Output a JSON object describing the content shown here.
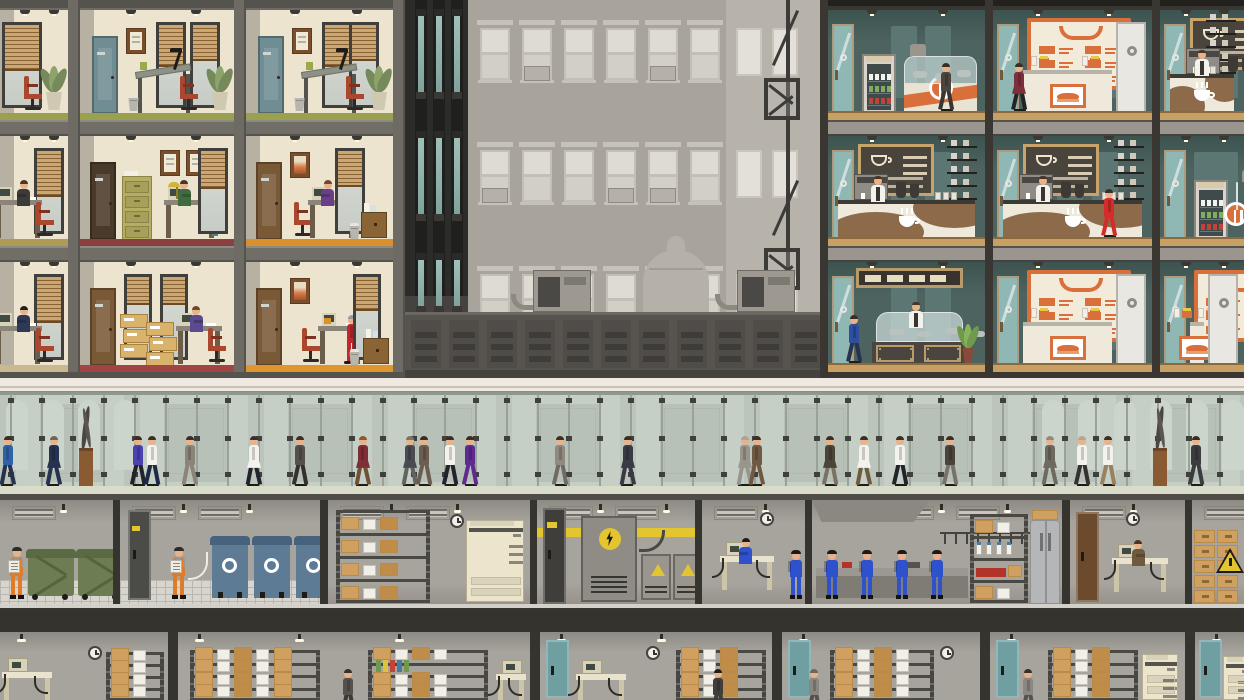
{
  "scene": {
    "title": "Skyscraper cross-section: offices, food court, glass lobby, basement utility and archive levels",
    "palette": {
      "officeWall": "#ece4cf",
      "officeShade": "#c2bba7",
      "frameGray": "#6e6b64",
      "slab": "#716e67",
      "slabLine": "#55534e",
      "doorTeal": "#6f8d92",
      "doorBrown": "#7a5936",
      "doorDark": "#4a3a2a",
      "chairRed": "#a9472f",
      "floorOlive": "#9aa04e",
      "floorTan": "#b09a58",
      "floorBeige": "#c9b98f",
      "floorRed": "#8c3f3f",
      "floorDarkRed": "#a04444",
      "floorOrange": "#d9912e",
      "floorOrange2": "#e0962e",
      "towerDark": "#2c2c2a",
      "towerGlass": "#9fc0b8",
      "bgBuilding": "#a8a49c",
      "bgWindow": "#dedbd3",
      "bgBuilding2": "#b7b3ab",
      "parapet": "#57544f",
      "parapetSlot": "#3e3c38",
      "cafeWall": "#4c6360",
      "cafeWallDark": "#3d5350",
      "cafeFloor": "#c9a063",
      "cafeFrame": "#3a3733",
      "orange": "#d96f3a",
      "cream": "#f3ebd9",
      "counter": "#efe9dc",
      "counterWave": "#8c6a4a",
      "chalk": "#49443c",
      "chalkFrame": "#c8a36a",
      "lobbyTop": "#efe9e2",
      "lobbyGlass": "#c9d2ca",
      "lobbyBack": "#c2c8c0",
      "mullion": "#99a299",
      "fitting": "#3f3f3b",
      "lobbyFloor": "#d9dcc9",
      "lobbyBase": "#4f4d48",
      "bsmtWall": "#a7a39d",
      "divider": "#35342f",
      "dumpster": "#6d7c52",
      "recycleBin": "#5e7b95",
      "copier": "#ece5cc",
      "box": "#cfa05f",
      "boxDark": "#b98a48",
      "steel": "#b4b6b8",
      "yellow": "#e3c52f",
      "overallsBlue": "#2e52cc",
      "overallsOrange": "#e07b28",
      "skin": "#e8b28a"
    },
    "office_building": {
      "floors": [
        {
          "y": 10,
          "units": [
            {
              "x": 0,
              "w": 68,
              "type": "corner",
              "floor": "#9aa04e",
              "door": null,
              "person": null
            },
            {
              "x": 80,
              "w": 154,
              "type": "draft",
              "floor": "#9aa04e",
              "door": "#6f8d92",
              "person": null
            },
            {
              "x": 246,
              "w": 147,
              "type": "draft",
              "floor": "#9aa04e",
              "door": "#6f8d92",
              "person": null
            }
          ]
        },
        {
          "y": 136,
          "units": [
            {
              "x": 0,
              "w": 68,
              "type": "clerk",
              "floor": "#b09a58",
              "door": null,
              "person": {
                "shirt": "#3c3b39",
                "hair": "#4a3526"
              }
            },
            {
              "x": 80,
              "w": 154,
              "type": "manager",
              "floor": "#8c3f3f",
              "door": "#4a3a2a",
              "person": {
                "shirt": "#3f6b3f",
                "hair": "#4a3526"
              }
            },
            {
              "x": 246,
              "w": 147,
              "type": "clerk2",
              "floor": "#d9912e",
              "door": "#7a5936",
              "person": {
                "shirt": "#6a3f8a",
                "hair": "#6b4a2e"
              }
            }
          ]
        },
        {
          "y": 262,
          "units": [
            {
              "x": 0,
              "w": 68,
              "type": "clerk",
              "floor": "#c9b98f",
              "door": null,
              "person": {
                "shirt": "#2e3a55",
                "hair": "#22201c"
              }
            },
            {
              "x": 80,
              "w": 154,
              "type": "archive",
              "floor": "#a04444",
              "door": "#7a5936",
              "person": {
                "shirt": "#5b4a8f",
                "hair": "#6b4a2e"
              }
            },
            {
              "x": 246,
              "w": 147,
              "type": "visit",
              "floor": "#e0962e",
              "door": "#7a5936",
              "person": {
                "shirt": "#c4262e",
                "hair": "#9a9a96"
              }
            }
          ]
        }
      ]
    },
    "food_court": {
      "floors": [
        {
          "y": 10,
          "units": [
            {
              "x": 8,
              "w": 157,
              "type": "deli",
              "people": [
                {
                  "x": 118,
                  "k": "walk",
                  "t": "#4a453f",
                  "b": "#3a362f"
                }
              ]
            },
            {
              "x": 173,
              "w": 159,
              "type": "sandwich",
              "people": [
                {
                  "x": 26,
                  "k": "walk",
                  "t": "#7e2f3c",
                  "b": "#23232b",
                  "f": 1
                }
              ]
            },
            {
              "x": 340,
              "w": 84,
              "type": "coffee",
              "people": [
                {
                  "x": 34,
                  "k": "barista"
                }
              ]
            }
          ]
        },
        {
          "y": 136,
          "units": [
            {
              "x": 8,
              "w": 157,
              "type": "coffee",
              "people": [
                {
                  "x": 42,
                  "k": "barista"
                }
              ]
            },
            {
              "x": 173,
              "w": 159,
              "type": "coffee",
              "people": [
                {
                  "x": 42,
                  "k": "barista"
                },
                {
                  "x": 116,
                  "k": "walk",
                  "t": "#d42b2b",
                  "b": "#d42b2b"
                }
              ]
            },
            {
              "x": 340,
              "w": 84,
              "type": "deli",
              "people": []
            }
          ]
        },
        {
          "y": 262,
          "units": [
            {
              "x": 8,
              "w": 157,
              "type": "sushi",
              "people": [
                {
                  "x": 26,
                  "k": "walk",
                  "t": "#2e4f9e",
                  "b": "#26324e"
                },
                {
                  "x": 80,
                  "k": "barista"
                }
              ]
            },
            {
              "x": 173,
              "w": 159,
              "type": "sandwich",
              "people": []
            },
            {
              "x": 340,
              "w": 84,
              "type": "sandwich",
              "people": []
            }
          ]
        }
      ]
    },
    "backdrop": {
      "tower": {
        "w": 63,
        "cols": [
          13,
          31,
          49
        ],
        "strips": [
          [
            16,
            76
          ],
          [
            138,
            76
          ],
          [
            260,
            46
          ]
        ]
      },
      "window_rows": [
        28,
        150,
        274
      ],
      "window_cols": [
        75,
        117,
        159,
        201,
        243,
        285
      ],
      "ac": [
        [
          0,
          1
        ],
        [
          0,
          4
        ],
        [
          1,
          0
        ],
        [
          1,
          3
        ],
        [
          1,
          4
        ],
        [
          2,
          2
        ]
      ],
      "building2": {
        "x": 321,
        "w": 94,
        "win_cols": [
          10,
          46
        ]
      },
      "fire_escape_x": 381,
      "water_tank": {
        "x": 238,
        "w": 66
      },
      "hvac_x": [
        128,
        332
      ],
      "parapet_y": 312
    },
    "lobby": {
      "sculptures": [
        {
          "x": 86
        },
        {
          "x": 1160
        }
      ],
      "people": [
        {
          "x": 8,
          "t": "#2f63a8",
          "b": "#26324e",
          "d": -1
        },
        {
          "x": 54,
          "t": "#26324e",
          "b": "#26324e",
          "f": 1,
          "hair": "#6a675f",
          "d": -1
        },
        {
          "x": 138,
          "t": "#4a42b0",
          "b": "#23232b"
        },
        {
          "x": 152,
          "t": "#f4f2ec",
          "b": "#1d2a47"
        },
        {
          "x": 190,
          "t": "#8a8578",
          "b": "#8a8578",
          "d": -1
        },
        {
          "x": 254,
          "t": "#f4f2ec",
          "b": "#23232b",
          "f": 1,
          "d": -1
        },
        {
          "x": 300,
          "t": "#55504a",
          "b": "#33312e"
        },
        {
          "x": 363,
          "t": "#7e2f35",
          "b": "#6d5335",
          "f": 1,
          "hair": "#8a5b33",
          "d": -1
        },
        {
          "x": 410,
          "t": "#4a4a52",
          "b": "#62625f",
          "f": 1,
          "hair": "#777770",
          "d": -1
        },
        {
          "x": 424,
          "t": "#6b5d4f",
          "b": "#6b5d4f"
        },
        {
          "x": 450,
          "t": "#f4f2ec",
          "b": "#23232b"
        },
        {
          "x": 470,
          "t": "#5e2a8f",
          "b": "#5e2a8f"
        },
        {
          "x": 560,
          "t": "#8f8a80",
          "b": "#6f6b62"
        },
        {
          "x": 628,
          "t": "#3a3a44",
          "b": "#3a3a44",
          "f": 1,
          "d": -1
        },
        {
          "x": 745,
          "t": "#9a958c",
          "b": "#9a958c",
          "f": 1,
          "hair": "#a8a49c",
          "d": -1
        },
        {
          "x": 757,
          "t": "#6e5a42",
          "b": "#6e5a42",
          "d": -1
        },
        {
          "x": 830,
          "t": "#4b4438",
          "b": "#7a7262",
          "f": 1
        },
        {
          "x": 864,
          "t": "#f4f2ec",
          "b": "#6d5b40",
          "f": 1,
          "d": -1
        },
        {
          "x": 900,
          "t": "#f4f2ec",
          "b": "#23232b"
        },
        {
          "x": 950,
          "t": "#4a433a",
          "b": "#77736a"
        },
        {
          "x": 1050,
          "t": "#6e6a60",
          "b": "#6e6a60",
          "f": 1,
          "hair": "#8d8a82",
          "d": -1
        },
        {
          "x": 1082,
          "t": "#f4f2ec",
          "b": "#33322f",
          "hair": "#b5a88f"
        },
        {
          "x": 1108,
          "t": "#f4f2ec",
          "b": "#97815f"
        },
        {
          "x": 1196,
          "t": "#3c3c3f",
          "b": "#3c3c3f"
        }
      ]
    },
    "basement1": {
      "rooms": [
        {
          "x": 0,
          "w": 113,
          "type": "waste"
        },
        {
          "x": 120,
          "w": 200,
          "type": "recycling"
        },
        {
          "x": 328,
          "w": 202,
          "type": "storage"
        },
        {
          "x": 537,
          "w": 158,
          "type": "electrical"
        },
        {
          "x": 702,
          "w": 103,
          "type": "itdesk"
        },
        {
          "x": 812,
          "w": 250,
          "type": "workshop"
        },
        {
          "x": 1070,
          "w": 115,
          "type": "office"
        },
        {
          "x": 1192,
          "w": 52,
          "type": "boxes"
        }
      ]
    },
    "basement2": {
      "rooms": [
        {
          "x": 0,
          "w": 168,
          "v": 0
        },
        {
          "x": 178,
          "w": 352,
          "v": 1
        },
        {
          "x": 540,
          "w": 232,
          "v": 2
        },
        {
          "x": 782,
          "w": 198,
          "v": 3
        },
        {
          "x": 990,
          "w": 195,
          "v": 4
        },
        {
          "x": 1195,
          "w": 49,
          "v": 5
        }
      ]
    }
  }
}
